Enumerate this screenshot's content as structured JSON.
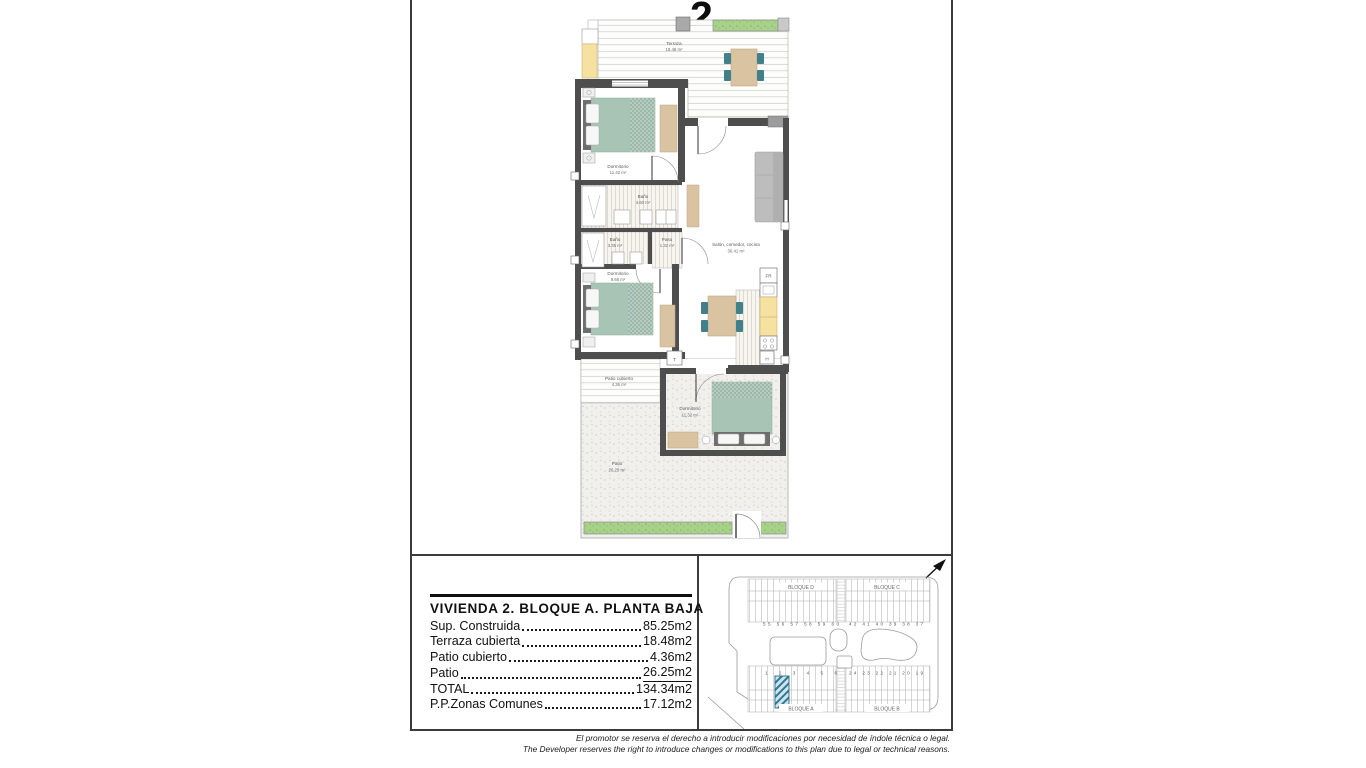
{
  "page": {
    "unit_number": "2",
    "disclaimer_es": "El promotor se reserva el derecho a introducir modificaciones por necesidad de índole técnica o legal.",
    "disclaimer_en": "The Developer reserves the right to introduce changes or modifications to this plan due to legal or technical reasons."
  },
  "summary_table": {
    "title": "VIVIENDA 2. BLOQUE A. PLANTA BAJA",
    "rows": [
      {
        "label": "Sup. Construida",
        "value": "85.25m2"
      },
      {
        "label": "Terraza cubierta",
        "value": "18.48m2"
      },
      {
        "label": "Patio cubierto",
        "value": "4.36m2"
      },
      {
        "label": "Patio",
        "value": "26.25m2"
      },
      {
        "label": "TOTAL",
        "value": "134.34m2"
      },
      {
        "label": "P.P.Zonas Comunes",
        "value": "17.12m2"
      }
    ]
  },
  "floorplan": {
    "rooms": [
      {
        "name": "Terraza",
        "area": "18.48 m²"
      },
      {
        "name": "Dormitorio",
        "area": "11.42 m²"
      },
      {
        "name": "Baño",
        "area": "4.60 m²"
      },
      {
        "name": "Baño",
        "area": "3.35 m²"
      },
      {
        "name": "Paso",
        "area": "1.32 m²"
      },
      {
        "name": "Dormitorio",
        "area": "9.68 m²"
      },
      {
        "name": "Salón, comedor, cocina",
        "area": "30.41 m²"
      },
      {
        "name": "Patio cubierto",
        "area": "4.36 m²"
      },
      {
        "name": "Dormitorio",
        "area": "11.32 m²"
      },
      {
        "name": "Patio",
        "area": "26.25 m²"
      }
    ],
    "markers": {
      "fridge": "FR",
      "tank": "T",
      "heater": "H"
    }
  },
  "siteplan": {
    "blocks": {
      "d": "BLOQUE D",
      "c": "BLOQUE C",
      "a": "BLOQUE A",
      "b": "BLOQUE B"
    },
    "unit_rows": {
      "top_left": "55 56 57 58 59 60",
      "top_right": "42 41 40 39 38 37",
      "bottom_left": "1 2 3 4 5 6",
      "bottom_right": "24 23 22 21 20 19"
    },
    "highlighted_unit": "2"
  },
  "colors": {
    "wall": "#4e4e4e",
    "bed": "#a7c4b5",
    "tan": "#d9c3a0",
    "chair": "#41808a",
    "counter_yellow": "#f7e1a1",
    "planter_green": "#a8d289",
    "hatch_teal": "#2e7893",
    "sofa_gray": "#bdbdbd",
    "line_gray": "#9b9b9b"
  }
}
